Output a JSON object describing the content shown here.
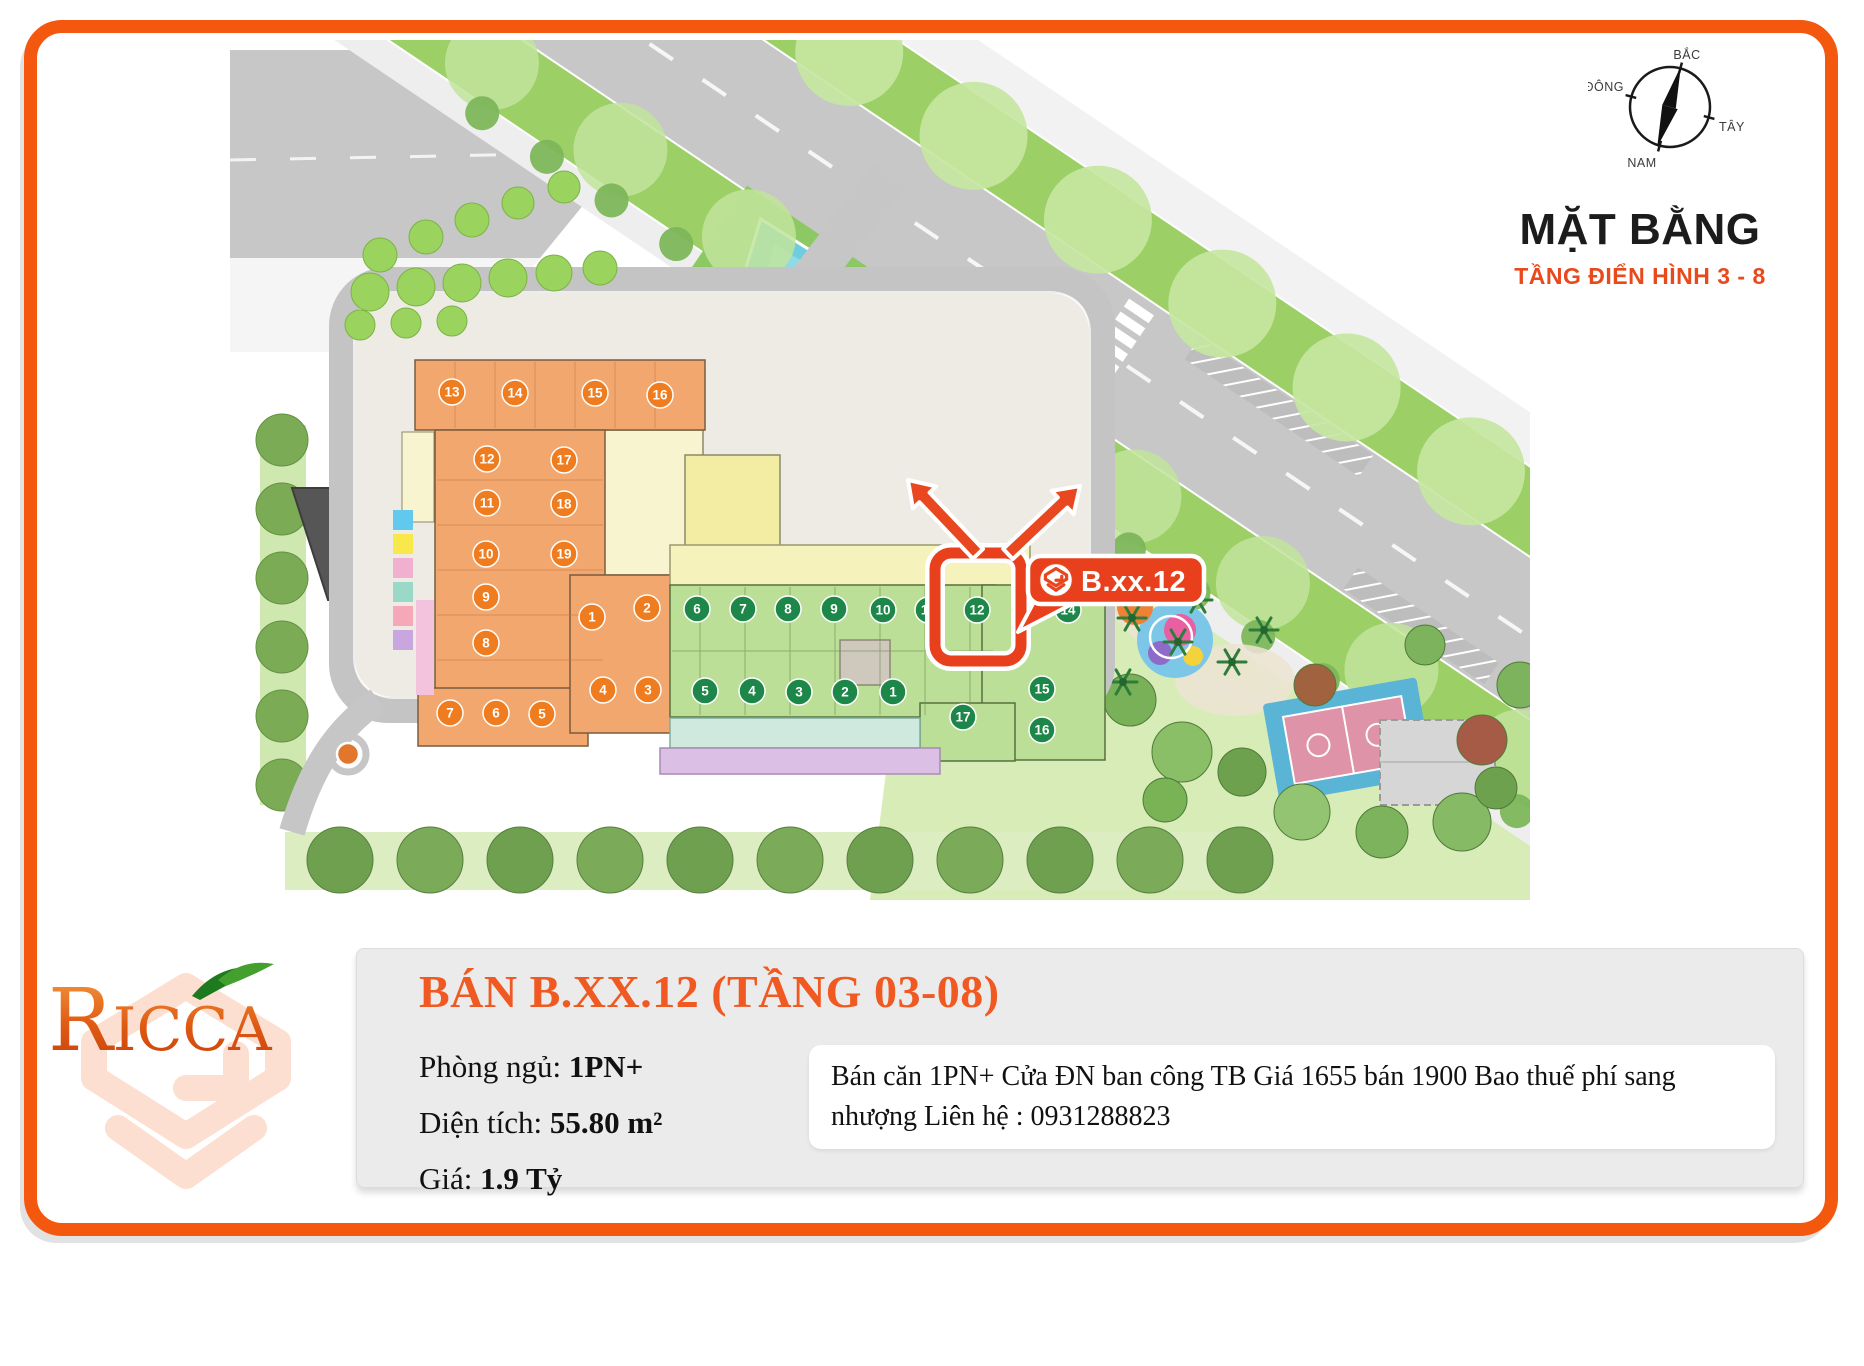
{
  "header": {
    "title": "MẶT BẰNG",
    "subtitle": "TẦNG ĐIỂN HÌNH 3 - 8"
  },
  "compass": {
    "north": "BẮC",
    "south": "NAM",
    "east": "ĐÔNG",
    "west": "TÂY"
  },
  "callout": {
    "unit_label": "B.xx.12"
  },
  "site_plan": {
    "highlighted_unit": "12",
    "block_a_units": [
      "13",
      "14",
      "15",
      "16",
      "12",
      "17",
      "11",
      "18",
      "10",
      "19",
      "9",
      "8",
      "7",
      "6",
      "5",
      "1",
      "2",
      "3",
      "4"
    ],
    "block_b_top_units": [
      "6",
      "7",
      "8",
      "9",
      "10",
      "11",
      "12"
    ],
    "block_b_bottom_units": [
      "5",
      "4",
      "3",
      "2",
      "1"
    ],
    "block_b_right_units": [
      "14",
      "15",
      "16",
      "17"
    ],
    "colors": {
      "frame": "#f4570e",
      "accent": "#e8491d",
      "highlight": "#e8401c",
      "block_a_fill": "#f2a76f",
      "block_b_fill": "#bcdf97",
      "badge_a": "#ef7c1f",
      "badge_b": "#1d8649"
    }
  },
  "logo": {
    "brand": "Ricca"
  },
  "info_card": {
    "title": "BÁN B.XX.12 (TẦNG 03-08)",
    "fields": [
      {
        "label": "Phòng ngủ:",
        "value": "1PN+"
      },
      {
        "label": "Diện tích:",
        "value": "55.80 m²"
      },
      {
        "label": "Giá:",
        "value": "1.9 Tỷ"
      }
    ],
    "description": "Bán căn 1PN+ Cửa ĐN ban công TB Giá 1655 bán 1900 Bao thuế phí sang nhượng Liên hệ : 0931288823"
  }
}
